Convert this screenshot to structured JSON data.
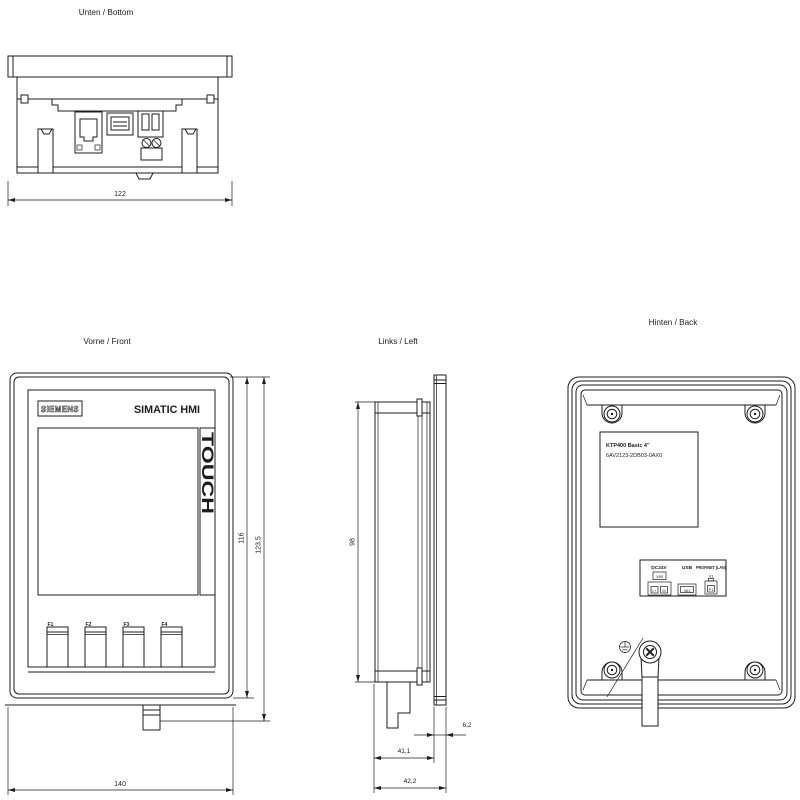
{
  "page": {
    "background": "#ffffff",
    "line_color": "#1d1d1d"
  },
  "views": {
    "bottom": {
      "title": "Unten / Bottom",
      "dim_width": "122"
    },
    "front": {
      "title": "Vorne / Front",
      "brand": "SIEMENS",
      "product": "SIMATIC HMI",
      "touch_label": "TOUCH",
      "keys": [
        "F1",
        "F2",
        "F3",
        "F4"
      ],
      "dim_inner_height": "116",
      "dim_outer_height": "123,5",
      "dim_width": "140"
    },
    "left": {
      "title": "Links / Left",
      "dim_height": "98",
      "dim_bezel_depth": "6,2",
      "dim_body_depth": "41,1",
      "dim_total_depth": "42,2"
    },
    "back": {
      "title": "Hinten / Back",
      "type_label_line1": "KTP400 Basic 4\"",
      "type_label_line2": "6AV2123-2DB03-0AX0",
      "ports": {
        "power_label": "DC24V",
        "power_connector": "X80",
        "power_pin_l": "L+",
        "power_pin_m": "M",
        "usb_label": "USB",
        "usb_connector": "X61",
        "lan_label": "PROFINET (LAN)",
        "lan_interface": "X1",
        "lan_port": "P1"
      }
    }
  }
}
